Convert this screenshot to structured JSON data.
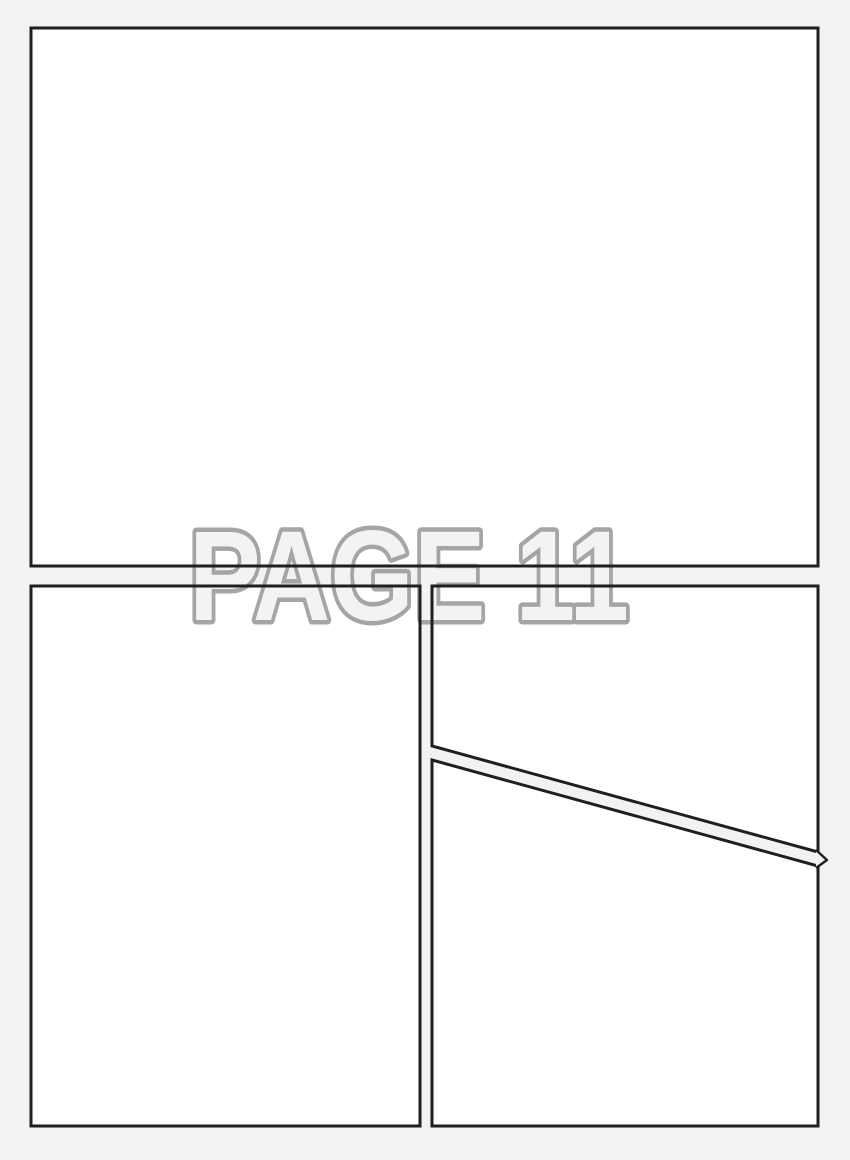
{
  "title": {
    "text": "PAGE 11"
  },
  "colors": {
    "background": "#f2f2f2",
    "panel_fill": "#ffffff",
    "panel_border": "#1f1f1f",
    "title_fill": "#f3f3f3",
    "title_stroke": "#a5a5a5"
  },
  "panels": [
    {
      "name": "top-full-width"
    },
    {
      "name": "bottom-left"
    },
    {
      "name": "bottom-right-upper"
    },
    {
      "name": "bottom-right-lower"
    }
  ]
}
